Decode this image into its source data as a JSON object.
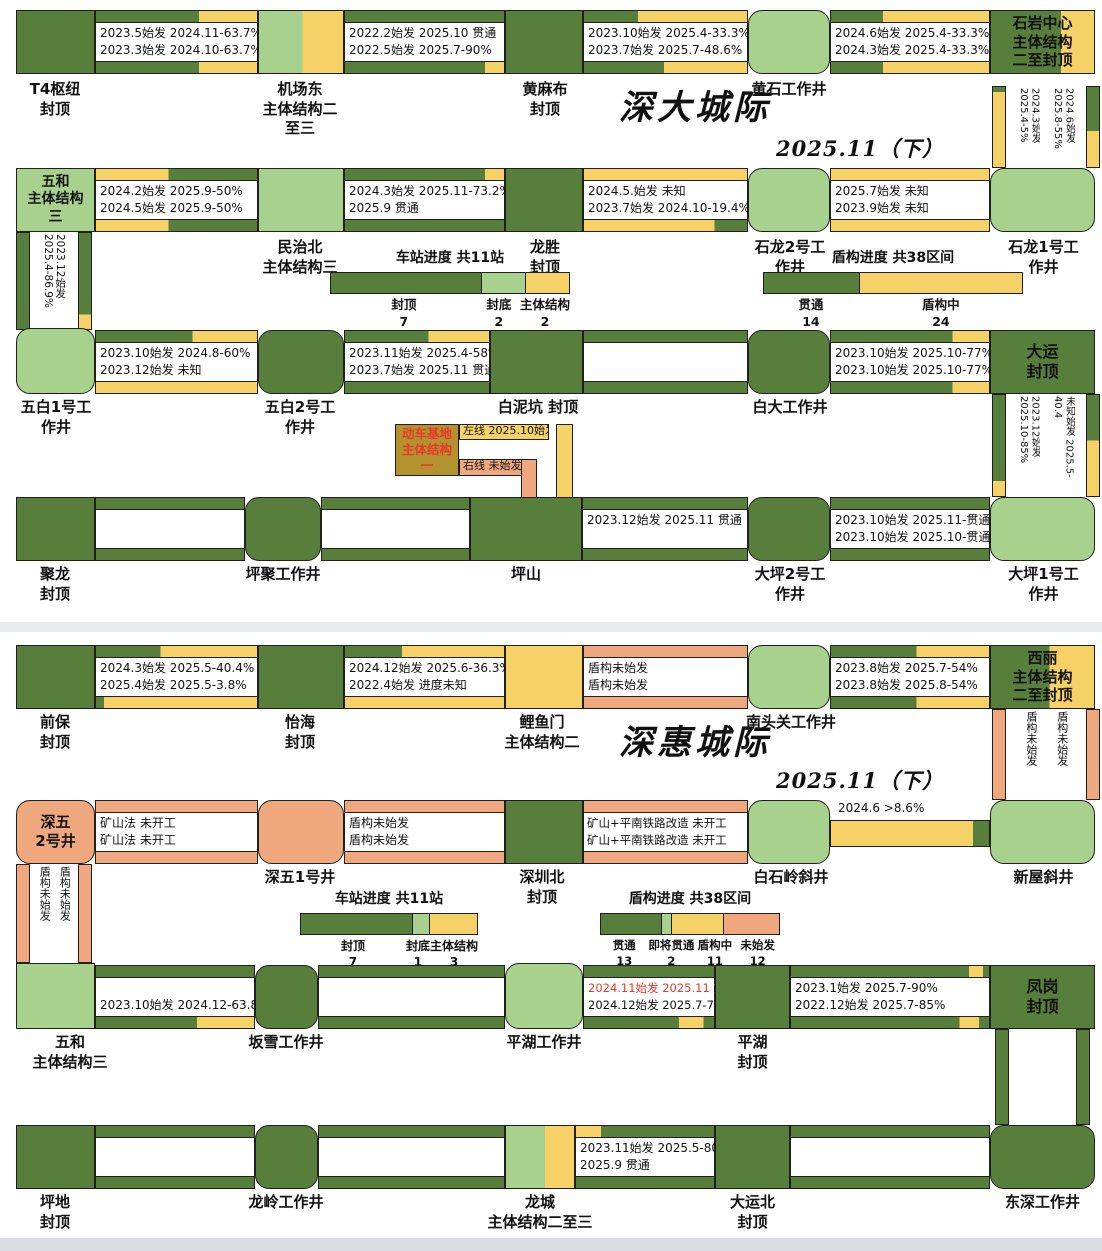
{
  "titles": {
    "sd": "深大城际",
    "sd_date": "2025.11（下）",
    "sh": "深惠城际",
    "sh_date": "2025.11（下）"
  },
  "colors": {
    "dark_green": "#587e3c",
    "light_green": "#a9d18e",
    "yellow": "#f6d166",
    "salmon": "#efa87d",
    "mustard": "#b3922f",
    "red_text": "#e8392b"
  },
  "n": {
    "t4": "T4枢纽\n封顶",
    "jcd": "机场东\n主体结构二\n至三",
    "hmb": "黄麻布\n封顶",
    "hs": "黄石工作井",
    "syzx": "石岩中心\n主体结构\n二至封顶",
    "wh1": "五和\n主体结构\n三",
    "mzb": "民治北\n主体结构三",
    "ls": "龙胜\n封顶",
    "sl2": "石龙2号工\n作井",
    "sl1": "石龙1号工\n作井",
    "wb1": "五白1号工\n作井",
    "wb2": "五白2号工\n作井",
    "bnk": "白泥坑 封顶",
    "bd": "白大工作井",
    "dy": "大运\n封顶",
    "jl": "聚龙\n封顶",
    "pj": "坪聚工作井",
    "ps": "坪山",
    "dp2": "大坪2号工\n作井",
    "dp1": "大坪1号工\n作井",
    "qb": "前保\n封顶",
    "yh": "怡海\n封顶",
    "lym": "鲤鱼门\n主体结构二",
    "ntg": "南头关工作井",
    "xl": "西丽\n主体结构\n二至封顶",
    "sw2": "深五\n2号井",
    "sw1": "深五1号井",
    "szb": "深圳北\n封顶",
    "bsl": "白石岭斜井",
    "xw": "新屋斜井",
    "wh2": "五和\n主体结构三",
    "bx": "坂雪工作井",
    "phj": "平湖工作井",
    "ph": "平湖\n封顶",
    "fg": "凤岗\n封顶",
    "pd": "坪地\n封顶",
    "ll": "龙岭工作井",
    "lc": "龙城\n主体结构二至三",
    "dyb": "大运北\n封顶",
    "ds": "东深工作井"
  },
  "s": {
    "a1": [
      "2023.5始发 2024.11-63.7%",
      "2023.3始发 2024.10-63.7%"
    ],
    "a2": [
      "2022.2始发 2025.10 贯通",
      "2022.5始发 2025.7-90%"
    ],
    "a3": [
      "2023.10始发 2025.4-33.3%",
      "2023.7始发 2025.7-48.6%"
    ],
    "a4": [
      "2024.6始发 2025.4-33.3%",
      "2024.3始发 2025.4-33.3%"
    ],
    "b1": [
      "2024.2始发 2025.9-50%",
      "2024.5始发 2025.9-50%"
    ],
    "b2": [
      "2024.3始发 2025.11-73.2%",
      "2025.9 贯通"
    ],
    "b3": [
      "2024.5.始发 未知",
      "2023.7始发 2024.10-19.4%"
    ],
    "b4": [
      "2025.7始发 未知",
      "2023.9始发 未知"
    ],
    "c1": [
      "2023.10始发 2024.8-60%",
      "2023.12始发 未知"
    ],
    "c2": [
      "2023.11始发 2025.4-58%",
      "2023.7始发 2025.11 贯通"
    ],
    "c4": [
      "2023.10始发 2025.10-77%",
      "2023.10始发 2025.10-77%"
    ],
    "d3": [
      "2023.12始发 2025.11 贯通"
    ],
    "d4": [
      "2023.10始发 2025.11-贯通",
      "2023.10始发 2025.10-贯通"
    ],
    "e1": [
      "2024.3始发 2025.5-40.4%",
      "2025.4始发 2025.5-3.8%"
    ],
    "e2": [
      "2024.12始发 2025.6-36.3%",
      "2022.4始发 进度未知"
    ],
    "e3": [
      "盾构未始发",
      "盾构未始发"
    ],
    "e4": [
      "2023.8始发 2025.7-54%",
      "2023.8始发 2025.8-54%"
    ],
    "f1": [
      "矿山法 未开工",
      "矿山法 未开工"
    ],
    "f2": [
      "盾构未始发",
      "盾构未始发"
    ],
    "f3": [
      "矿山+平南铁路改造 未开工",
      "矿山+平南铁路改造 未开工"
    ],
    "f4": [
      "2024.6 >8.6%"
    ],
    "g1": [
      "",
      "2023.10始发 2024.12-63.8%"
    ],
    "g3": [
      "2024.11始发 2025.11 贯通",
      "2024.12始发 2025.7-70%"
    ],
    "g4": [
      "2023.1始发 2025.7-90%",
      "2022.12始发 2025.7-85%"
    ],
    "h3": [
      "2023.11始发 2025.5-80%",
      "2025.9 贯通"
    ]
  },
  "v": {
    "v1": [
      "2024.3始发 2025.4-5%",
      "2024.6始发 2025.8-55%"
    ],
    "v2": [
      "2023.12始发 2025.4-86.9%"
    ],
    "v3": [
      "2023.12始发 2025.10-85%",
      "未知始发 2025.5-40.4"
    ],
    "v4": [
      "盾构未始发",
      "盾构未始发"
    ],
    "v5": [
      "盾构未始发",
      "盾构未始发"
    ]
  },
  "br": {
    "box": "动车基地\n主体结构一",
    "left": "左线 2025.10始发",
    "right": "右线 未始发"
  },
  "leg": {
    "sd_station": {
      "title": "车站进度 共11站",
      "items": [
        {
          "name": "封顶",
          "count": "7"
        },
        {
          "name": "封底",
          "count": "2"
        },
        {
          "name": "主体结构",
          "count": "2"
        }
      ]
    },
    "sd_shield": {
      "title": "盾构进度 共38区间",
      "items": [
        {
          "name": "贯通",
          "count": "14"
        },
        {
          "name": "盾构中",
          "count": "24"
        }
      ]
    },
    "sh_station": {
      "title": "车站进度 共11站",
      "items": [
        {
          "name": "封顶",
          "count": "7"
        },
        {
          "name": "封底",
          "count": "1"
        },
        {
          "name": "主体结构",
          "count": "3"
        }
      ]
    },
    "sh_shield": {
      "title": "盾构进度 共38区间",
      "items": [
        {
          "name": "贯通",
          "count": "13"
        },
        {
          "name": "即将贯通",
          "count": "2"
        },
        {
          "name": "盾构中",
          "count": "11"
        },
        {
          "name": "未始发",
          "count": "12"
        }
      ]
    }
  }
}
